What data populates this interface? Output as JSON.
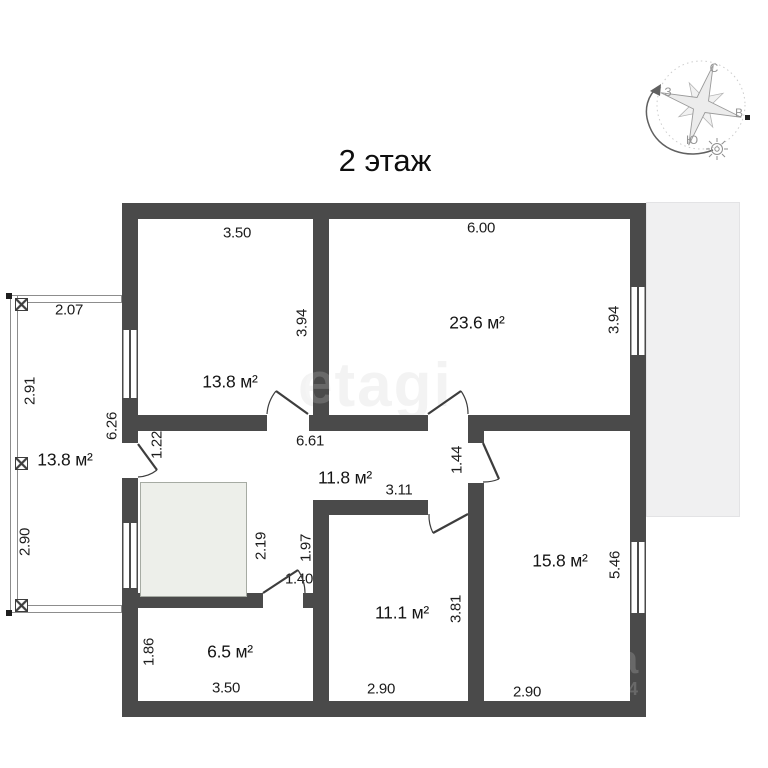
{
  "title": "2 этаж",
  "watermark": {
    "main": "etagi",
    "frag_letter": "a",
    "frag_number": "4.4",
    "wall_letter": "e"
  },
  "compass": {
    "north": "С",
    "east": "В",
    "south": "Ю",
    "west": "З"
  },
  "colors": {
    "wall": "#4a4a4a",
    "roof": "#f0f0f1",
    "stair": "#edefea",
    "dim-text": "#1c1c1c"
  },
  "rooms": {
    "top_left": "13.8 м²",
    "top_right": "23.6 м²",
    "hall": "11.8 м²",
    "right": "15.8 м²",
    "bottom_middle": "11.1 м²",
    "bottom_left": "6.5 м²",
    "balcony": "13.8 м²"
  },
  "dims": {
    "top_left_width": "3.50",
    "top_right_width": "6.00",
    "top_left_height": "3.94",
    "top_right_height": "3.94",
    "balcony_width": "2.07",
    "balcony_upper_height": "2.91",
    "balcony_lower_height": "2.90",
    "balcony_wall": "6.26",
    "balcony_door": "1.22",
    "hall_width": "6.61",
    "corridor_height": "1.44",
    "corridor_width": "3.11",
    "stair_height": "2.19",
    "stair_right": "1.97",
    "stair_door": "1.40",
    "right_height": "5.46",
    "bottom_middle_height": "3.81",
    "bottom_left_height": "1.86",
    "bottom_left_width": "3.50",
    "bottom_middle_width": "2.90",
    "right_width": "2.90"
  }
}
